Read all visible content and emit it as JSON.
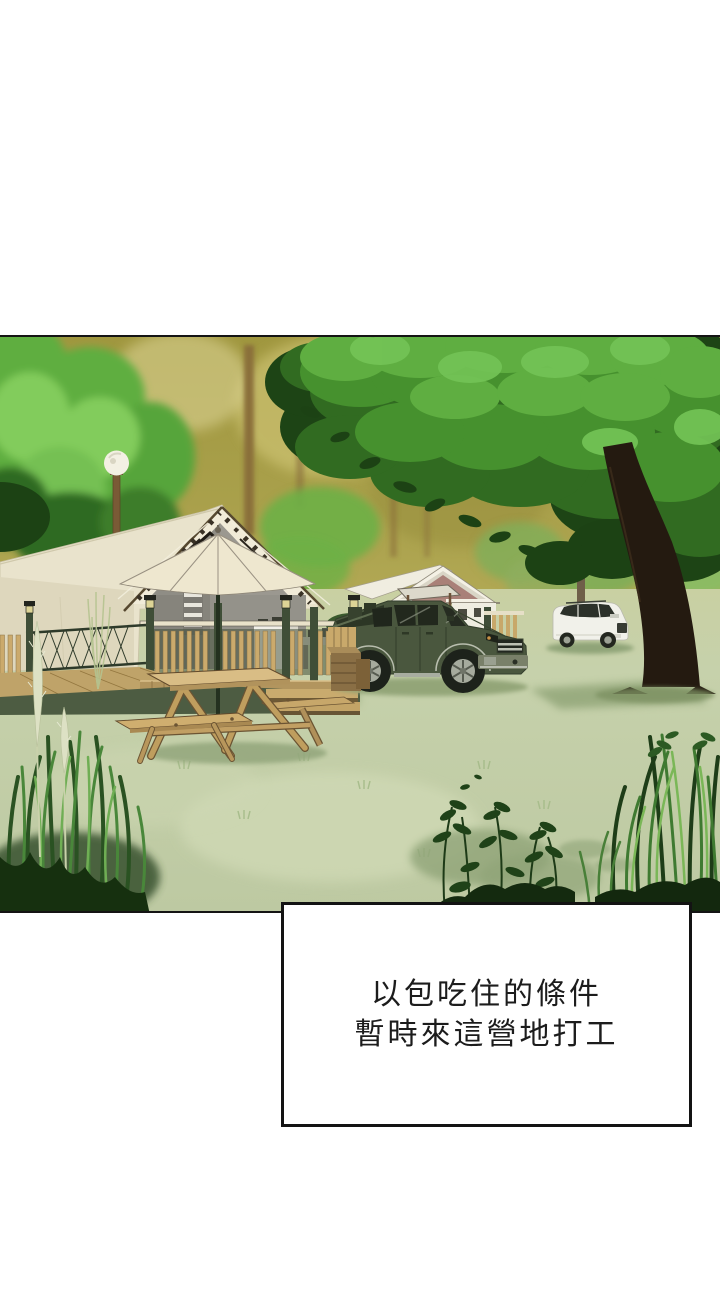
{
  "panel": {
    "description": "campsite-illustration"
  },
  "dialogue": {
    "line1": "以包吃住的條件",
    "line2": "暫時來這營地打工"
  },
  "palette": {
    "page_bg": "#ffffff",
    "panel_border": "#141414",
    "caption_bg": "#ffffff",
    "caption_border": "#131313",
    "caption_text": "#1c1c1c",
    "sky_olive": "#a89e4a",
    "canopy_green": "#46912e",
    "canopy_dark": "#1d4415",
    "tent_canvas": "#e9e3cc",
    "gable_canvas": "#f1ebd8",
    "truck_green": "#4a573e",
    "suv_white": "#f1f1ea",
    "ground_sage": "#c9d3ad",
    "wood_tan": "#cbaa6c",
    "deck_green": "#3f4e37",
    "grass_dark": "#16300f",
    "trunk_brown": "#241a10"
  }
}
